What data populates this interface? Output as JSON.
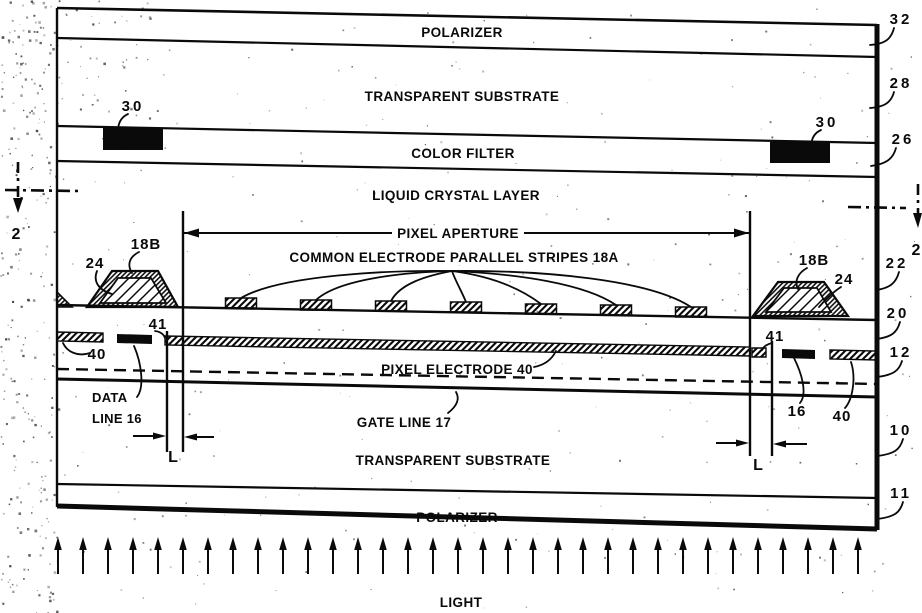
{
  "figure": {
    "layers": {
      "polarizer_top": "POLARIZER",
      "substrate_top": "TRANSPARENT SUBSTRATE",
      "color_filter": "COLOR FILTER",
      "liquid_crystal": "LIQUID CRYSTAL LAYER",
      "substrate_bottom": "TRANSPARENT SUBSTRATE",
      "polarizer_bottom": "POLARIZER"
    },
    "annotations": {
      "pixel_aperture": "PIXEL APERTURE",
      "common_electrode": "COMMON ELECTRODE PARALLEL STRIPES 18A",
      "pixel_electrode": "PIXEL ELECTRODE 40",
      "gate_line": "GATE LINE 17",
      "data_line_word1": "DATA",
      "data_line_word2": "LINE 16",
      "light": "LIGHT",
      "length": "L",
      "section": "2"
    },
    "refs": {
      "r32": "32",
      "r28": "28",
      "r26": "26",
      "r30": "30",
      "r22": "22",
      "r20": "20",
      "r12": "12",
      "r10": "10",
      "r11": "11",
      "r18b": "18B",
      "r24": "24",
      "r41": "41",
      "r16": "16",
      "r40": "40"
    },
    "light": {
      "arrow_count": 33
    },
    "colors": {
      "ink": "#0a0a0a",
      "paper": "#ffffff"
    }
  }
}
